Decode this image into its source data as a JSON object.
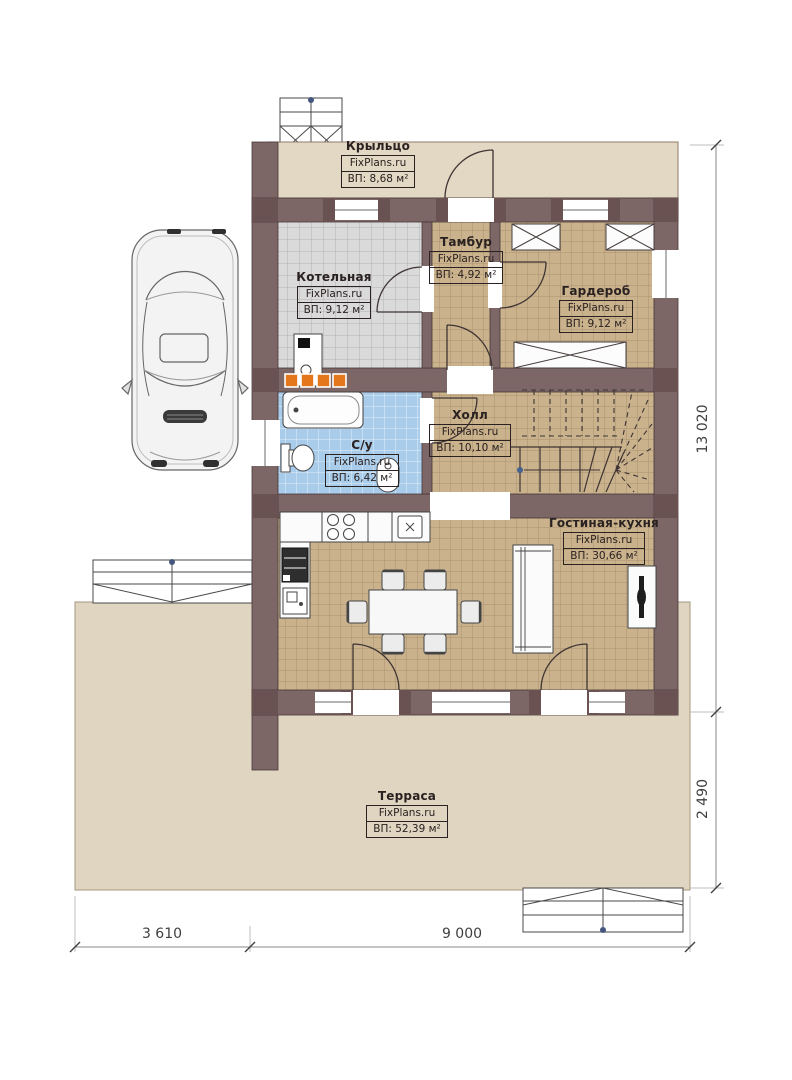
{
  "plan": {
    "site_brand": "FixPlans.ru",
    "rooms": [
      {
        "key": "porch",
        "name": "Крыльцо",
        "brand": "FixPlans.ru",
        "area": "ВП: 8,68 м²"
      },
      {
        "key": "boiler",
        "name": "Котельная",
        "brand": "FixPlans.ru",
        "area": "ВП: 9,12 м²"
      },
      {
        "key": "vestibule",
        "name": "Тамбур",
        "brand": "FixPlans.ru",
        "area": "ВП: 4,92 м²"
      },
      {
        "key": "wardrobe",
        "name": "Гардероб",
        "brand": "FixPlans.ru",
        "area": "ВП: 9,12 м²"
      },
      {
        "key": "hall",
        "name": "Холл",
        "brand": "FixPlans.ru",
        "area": "ВП: 10,10 м²"
      },
      {
        "key": "bathroom",
        "name": "С/у",
        "brand": "FixPlans.ru",
        "area": "ВП: 6,42 м²"
      },
      {
        "key": "living_kitchen",
        "name": "Гостиная-кухня",
        "brand": "FixPlans.ru",
        "area": "ВП: 30,66 м²"
      },
      {
        "key": "terrace",
        "name": "Терраса",
        "brand": "FixPlans.ru",
        "area": "ВП: 52,39 м²"
      }
    ],
    "dimensions": {
      "right_total": "13 020",
      "right_terrace": "2 490",
      "bottom_left": "3 610",
      "bottom_right": "9 000"
    },
    "colors": {
      "wall": "#7d6666",
      "wall_post": "#6b5252",
      "tile_tan": "#c9b28c",
      "tile_gray": "#dadada",
      "tile_blue": "#a9ccea",
      "surface_beige": "#e2d7c2",
      "radiator_orange": "#e4761b"
    }
  }
}
